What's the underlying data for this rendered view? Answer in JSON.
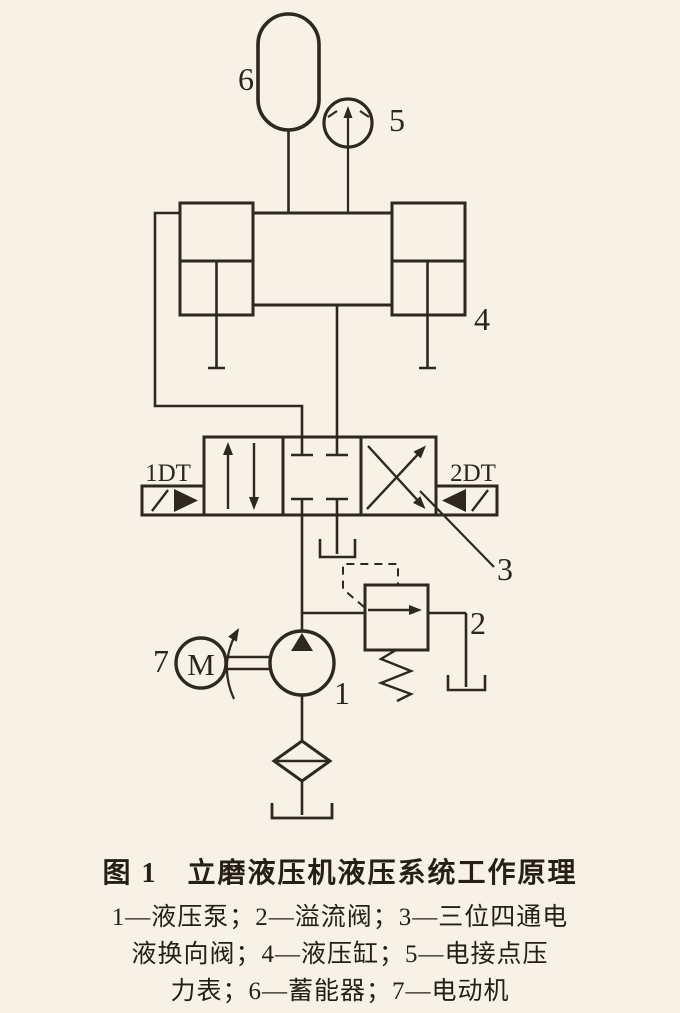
{
  "figure": {
    "component_labels": {
      "pump": "1",
      "relief_valve": "2",
      "directional_valve": "3",
      "cylinder": "4",
      "pressure_gauge": "5",
      "accumulator": "6",
      "motor": "7",
      "motor_letter": "M",
      "solenoid_left": "1DT",
      "solenoid_right": "2DT"
    },
    "caption": {
      "title": "图 1　立磨液压机液压系统工作原理",
      "legend_lines": [
        "1—液压泵；2—溢流阀；3—三位四通电",
        "液换向阀；4—液压缸；5—电接点压",
        "力表；6—蓄能器；7—电动机"
      ]
    },
    "colors": {
      "ink": "#2e281f",
      "paper": "#f6f2e6"
    }
  }
}
